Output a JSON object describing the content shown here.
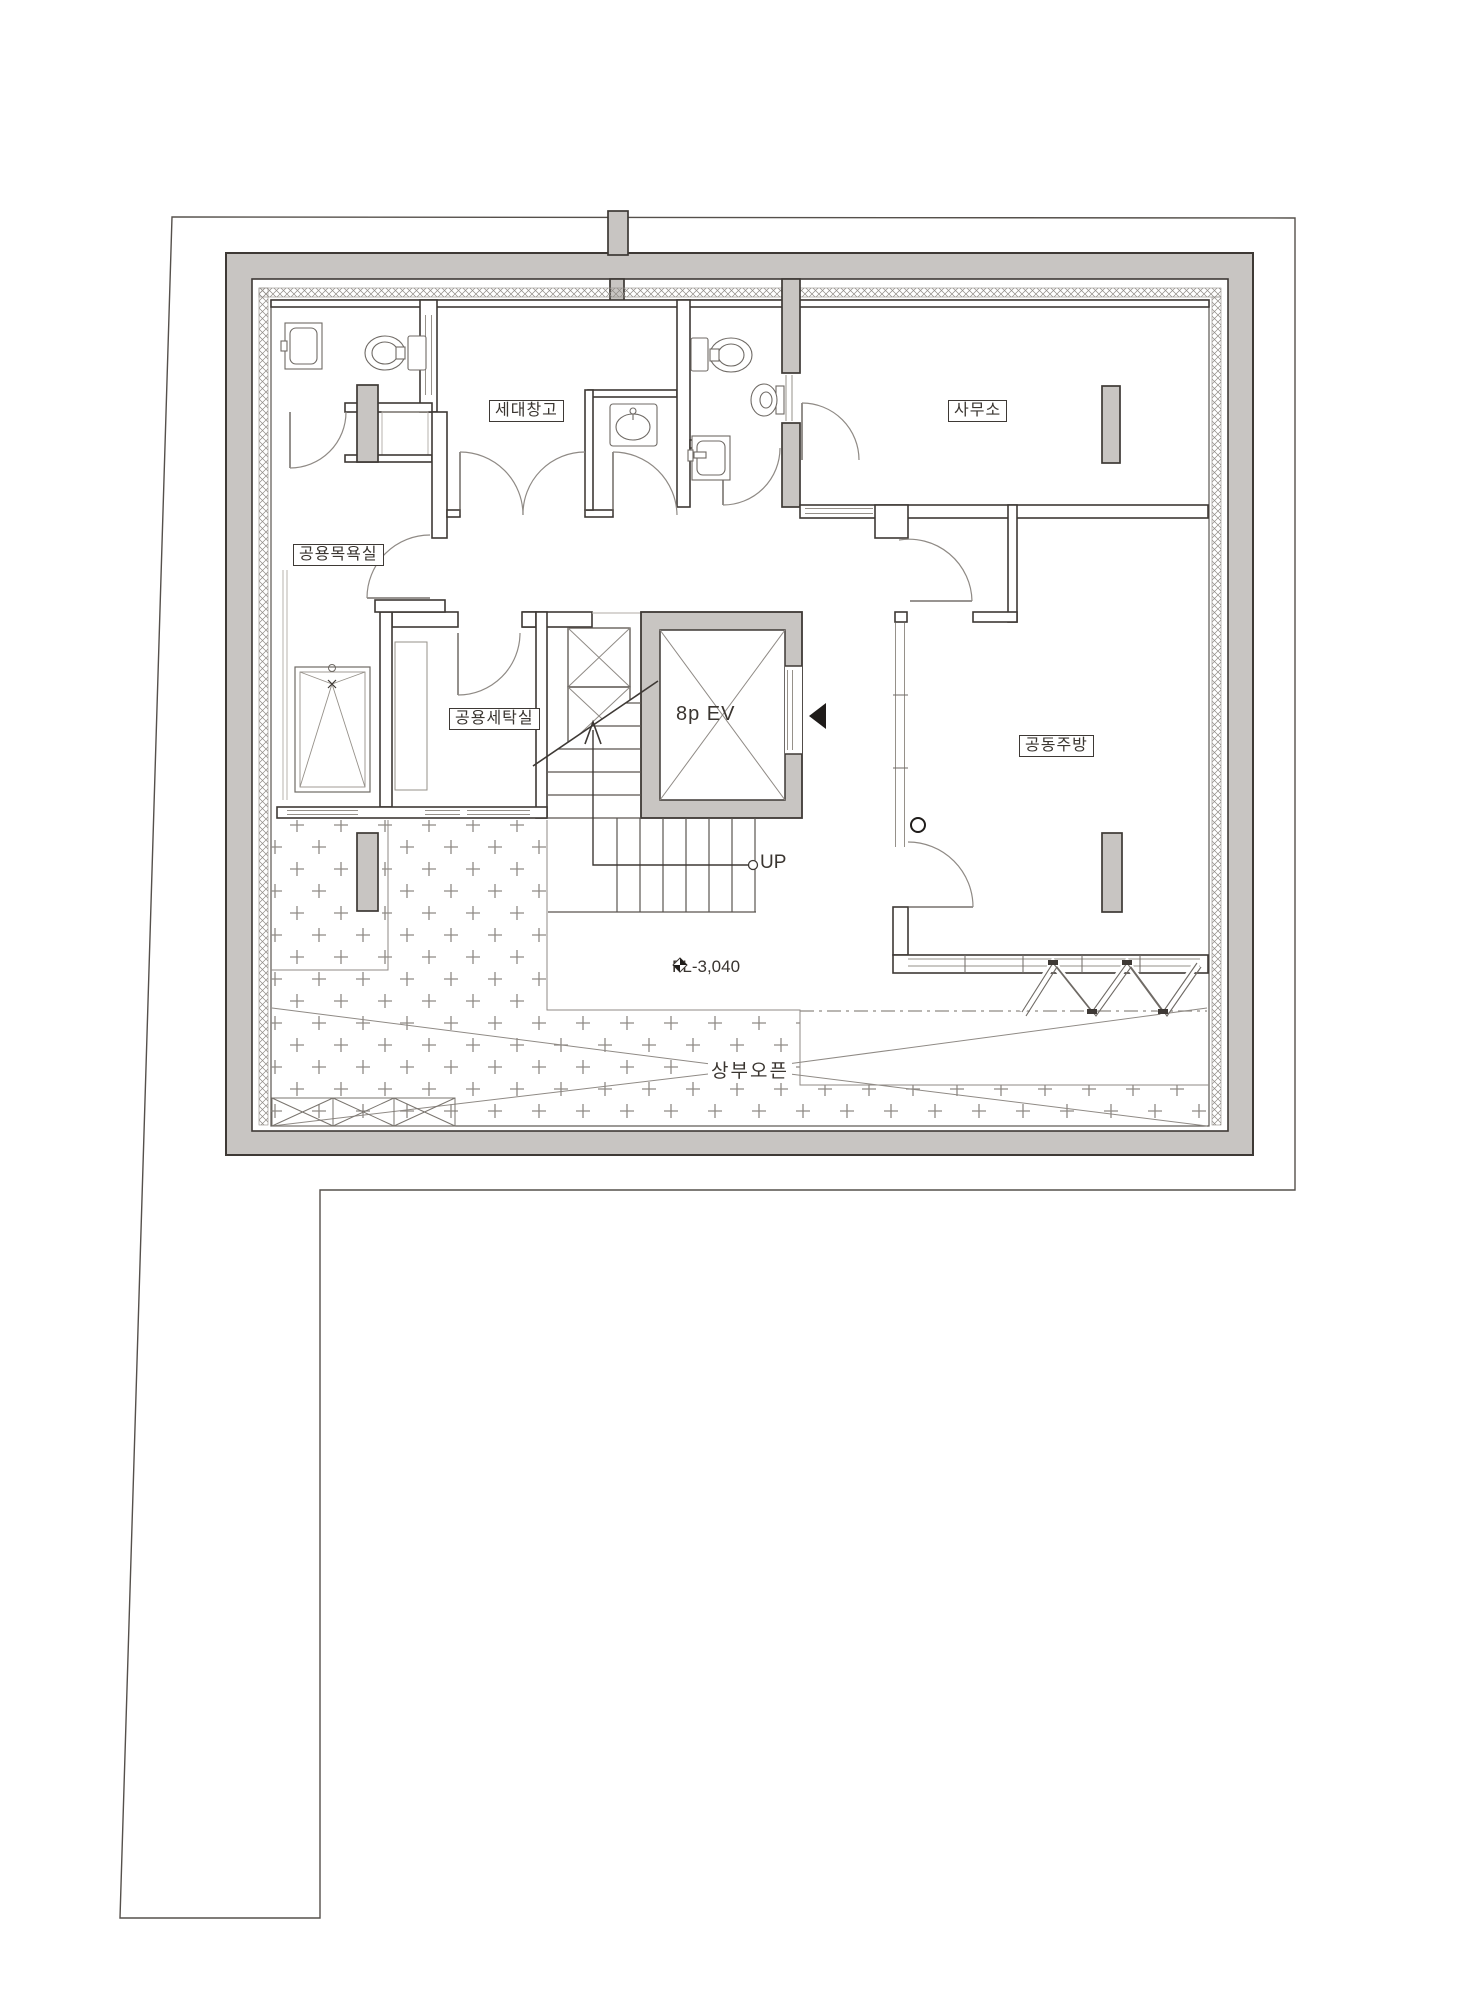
{
  "rooms": {
    "storage": "세대창고",
    "office": "사무소",
    "public_bath": "공용목욕실",
    "public_laundry": "공용세탁실",
    "shared_kitchen": "공동주방"
  },
  "elevator_label": "8p EV",
  "stair_up_label": "UP",
  "annotations": {
    "floor_level": "FL-3,040",
    "open_above": "상부오픈"
  },
  "colors": {
    "wall_gray": "#c8c5c2",
    "line_dark": "#3e3935",
    "line_medium": "#6f6a65",
    "line_light": "#96918a",
    "accent_black": "#1f1c1a"
  }
}
